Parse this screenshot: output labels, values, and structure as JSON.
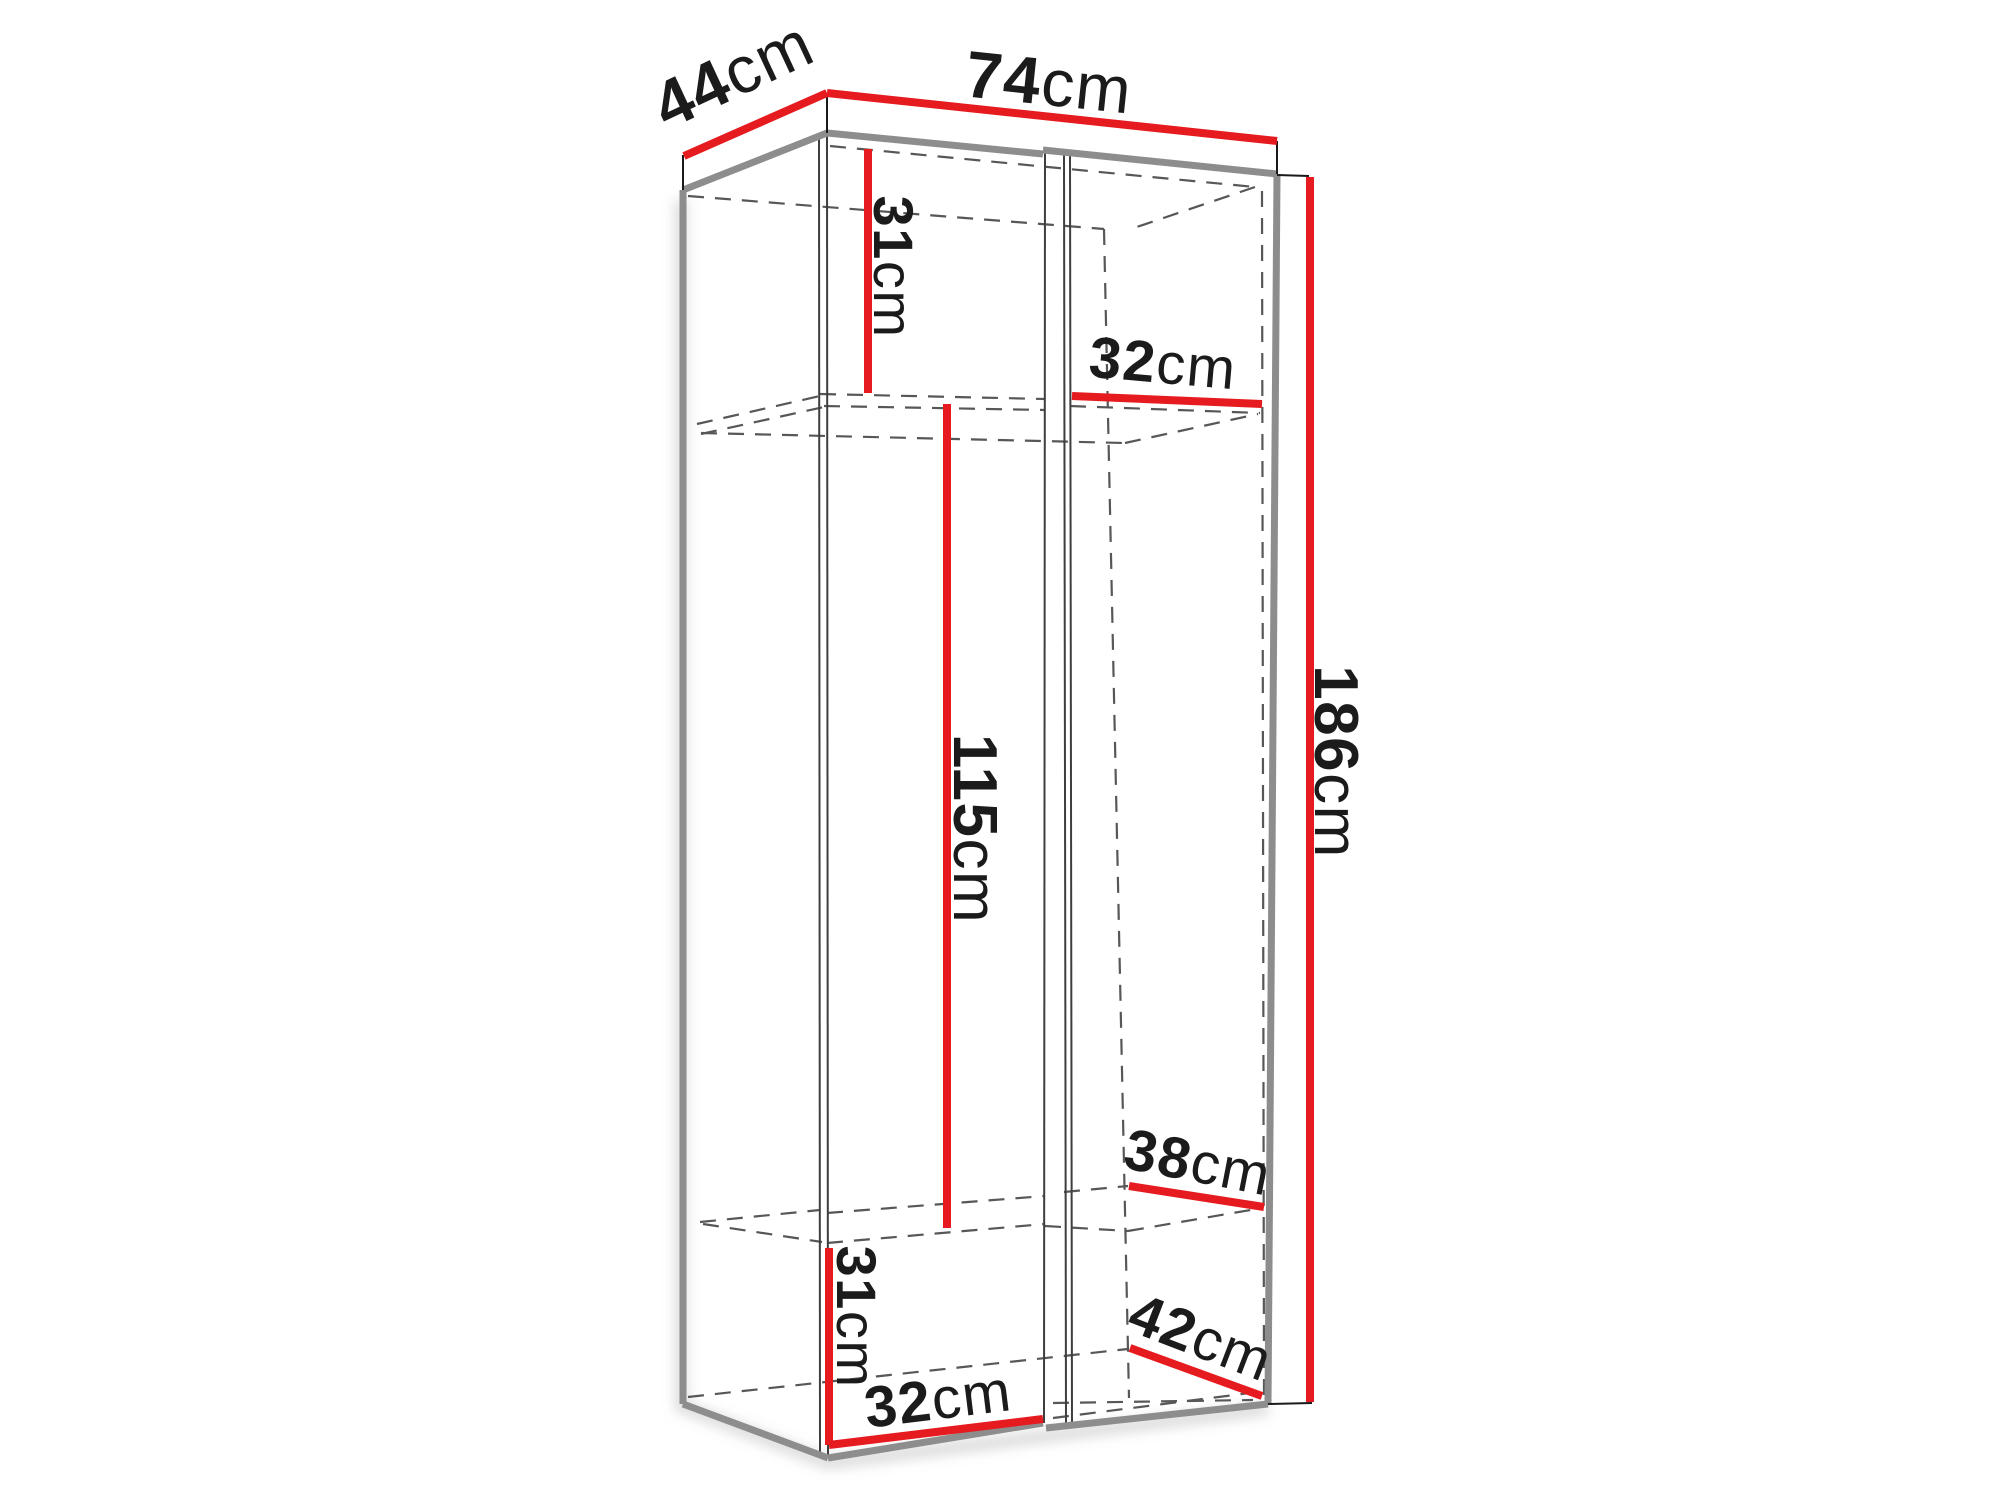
{
  "diagram": {
    "type": "furniture-dimension-drawing",
    "unit": "cm",
    "colors": {
      "dimension_line": "#e61b1f",
      "outline": "#8d8d8d",
      "hidden_edge": "#575757",
      "label_text": "#1b1b1b",
      "background": "#ffffff"
    }
  },
  "dimensions": {
    "dim_44": {
      "value": "44",
      "unit": "cm"
    },
    "dim_74": {
      "value": "74",
      "unit": "cm"
    },
    "dim_31_upper": {
      "value": "31",
      "unit": "cm"
    },
    "dim_32_upper": {
      "value": "32",
      "unit": "cm"
    },
    "dim_115": {
      "value": "115",
      "unit": "cm"
    },
    "dim_186": {
      "value": "186",
      "unit": "cm"
    },
    "dim_38": {
      "value": "38",
      "unit": "cm"
    },
    "dim_42": {
      "value": "42",
      "unit": "cm"
    },
    "dim_31_lower": {
      "value": "31",
      "unit": "cm"
    },
    "dim_32_lower": {
      "value": "32",
      "unit": "cm"
    }
  }
}
